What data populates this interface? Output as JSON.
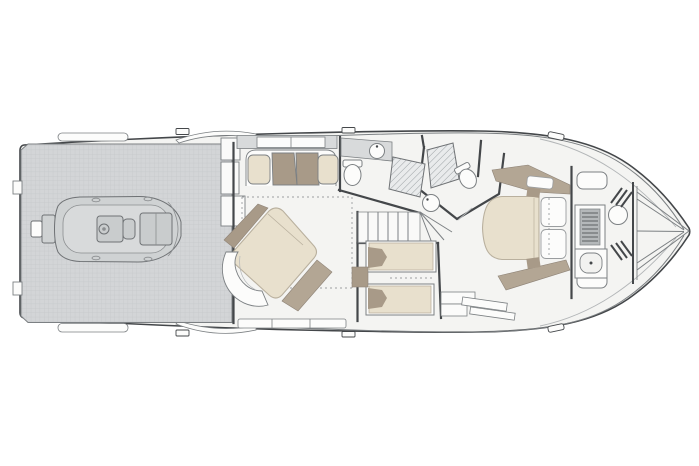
{
  "page": {
    "background": "#ffffff"
  },
  "diagram": {
    "kind": "yacht-lower-deck-floor-plan-top-view-bow-right",
    "description": "Line-drawing floor plan of a motor yacht lower deck, bow pointing right",
    "palette": {
      "page_bg": "#ffffff",
      "floor": "#f4f4f2",
      "line_dark": "#44474a",
      "line_mid": "#7c8083",
      "line_light": "#b3b6b8",
      "platform": "#d3d5d7",
      "platform_grid": "#c5c8ca",
      "counter_gray": "#d8dadb",
      "hatch_bg": "#e9ebec",
      "hatch_line": "#9aa0a3",
      "beige": "#e8e0cd",
      "beige_edge": "#b9b09e",
      "taupe": "#a89a88",
      "taupe2": "#b3a694",
      "white_furniture": "#fcfcfb",
      "tender_fill": "#cfd2d3",
      "tender_deck": "#d8dadb",
      "slat_gray": "#b4b8ba"
    },
    "areas": [
      {
        "id": "swim-platform",
        "name": "swim platform with tender storage"
      },
      {
        "id": "tender",
        "name": "tender RIB with outboard engine"
      },
      {
        "id": "master-cabin",
        "name": "master cabin with diagonal double bed, sofa and chaise"
      },
      {
        "id": "master-head",
        "name": "master bathroom with sink, toilet and shower"
      },
      {
        "id": "day-head",
        "name": "guest bathroom with shower, toilet and sink"
      },
      {
        "id": "staircase",
        "name": "companionway stairs"
      },
      {
        "id": "twin-cabin",
        "name": "twin guest cabin with two single berths"
      },
      {
        "id": "vip-cabin",
        "name": "forward VIP cabin with island bed"
      },
      {
        "id": "bow-compartment",
        "name": "bow utility compartment with seats, ladder and sink"
      },
      {
        "id": "anchor-locker",
        "name": "anchor locker"
      }
    ]
  }
}
